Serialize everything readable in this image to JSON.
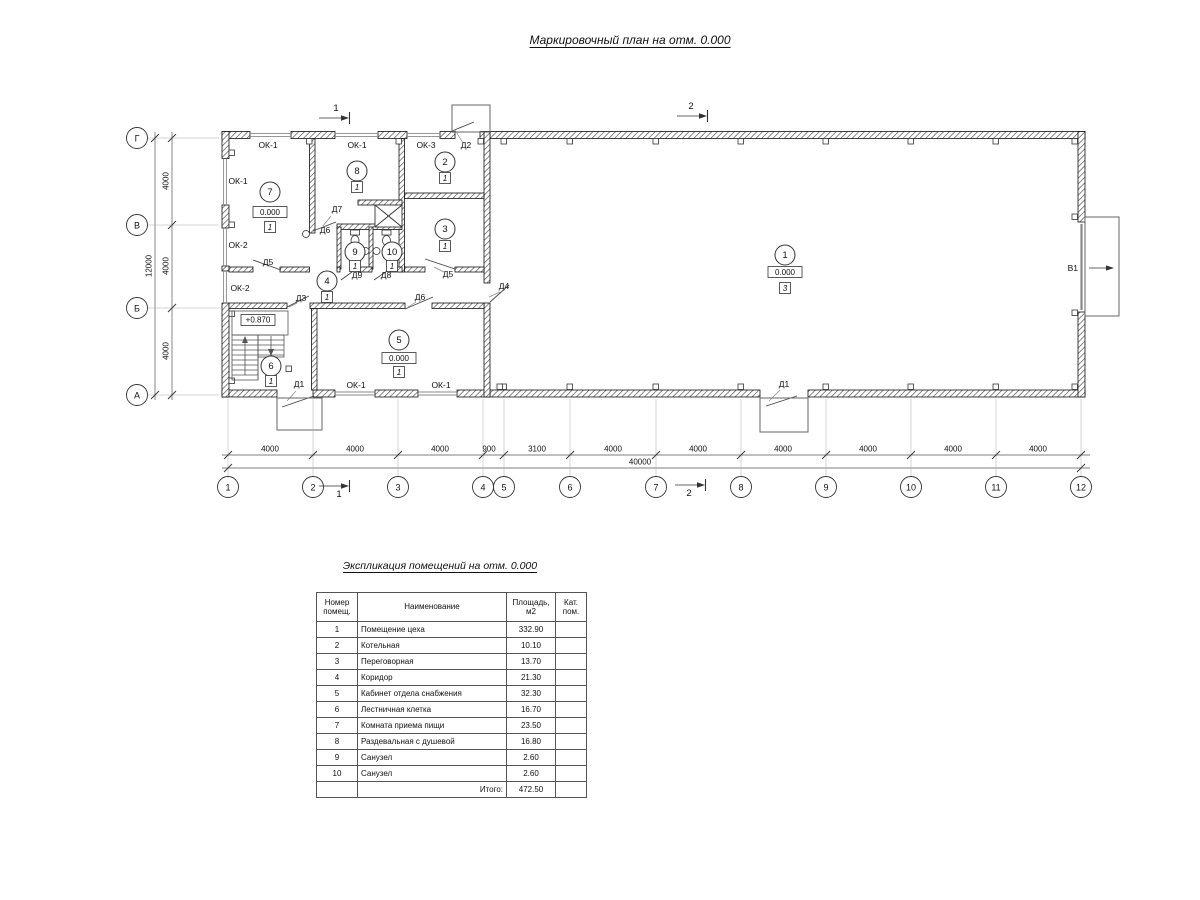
{
  "drawing": {
    "title": "Маркировочный план на отм. 0.000"
  },
  "plan": {
    "axes_cols": [
      [
        "1",
        228
      ],
      [
        "2",
        313
      ],
      [
        "3",
        398
      ],
      [
        "4",
        483
      ],
      [
        "5",
        504
      ],
      [
        "6",
        570
      ],
      [
        "7",
        656
      ],
      [
        "8",
        741
      ],
      [
        "9",
        826
      ],
      [
        "10",
        911
      ],
      [
        "11",
        996
      ],
      [
        "12",
        1081
      ]
    ],
    "axes_rows": [
      [
        "Г",
        138
      ],
      [
        "В",
        225
      ],
      [
        "Б",
        308
      ],
      [
        "А",
        395
      ]
    ],
    "dim_segments_bottom": [
      [
        "4000",
        270
      ],
      [
        "4000",
        355
      ],
      [
        "4000",
        440
      ],
      [
        "900",
        489
      ],
      [
        "3100",
        537
      ],
      [
        "4000",
        613
      ],
      [
        "4000",
        698
      ],
      [
        "4000",
        783
      ],
      [
        "4000",
        868
      ],
      [
        "4000",
        953
      ],
      [
        "4000",
        1038
      ]
    ],
    "dim_total_bottom": [
      "40000",
      640
    ],
    "dim_segments_left": [
      [
        "4000",
        181
      ],
      [
        "4000",
        266
      ],
      [
        "4000",
        351
      ]
    ],
    "dim_total_left": [
      "12000",
      266
    ],
    "marks": [
      [
        "ОК-1",
        268,
        148
      ],
      [
        "ОК-1",
        357,
        148
      ],
      [
        "ОК-3",
        426,
        148
      ],
      [
        "Д2",
        466,
        148
      ],
      [
        "ОК-1",
        238,
        184
      ],
      [
        "ОК-2",
        238,
        248
      ],
      [
        "ОК-2",
        240,
        291
      ],
      [
        "Д5",
        268,
        265
      ],
      [
        "Д6",
        325,
        233
      ],
      [
        "Д7",
        337,
        212
      ],
      [
        "Д5",
        448,
        277
      ],
      [
        "Д4",
        504,
        289
      ],
      [
        "Д9",
        357,
        278
      ],
      [
        "Д8",
        386,
        278
      ],
      [
        "Д3",
        301,
        301
      ],
      [
        "Д6",
        420,
        300
      ],
      [
        "Д1",
        299,
        387
      ],
      [
        "Д1",
        784,
        387
      ],
      [
        "ОК-1",
        356,
        388
      ],
      [
        "ОК-1",
        441,
        388
      ]
    ],
    "rooms": [
      {
        "num": "1",
        "cx": 785,
        "cy": 255,
        "elev": "0.000",
        "elev_y": 272,
        "cat": "3",
        "cat_y": 288
      },
      {
        "num": "2",
        "cx": 445,
        "cy": 162,
        "cat": "1",
        "cat_y": 178
      },
      {
        "num": "3",
        "cx": 445,
        "cy": 229,
        "cat": "1",
        "cat_y": 246
      },
      {
        "num": "4",
        "cx": 327,
        "cy": 281,
        "cat": "1",
        "cat_y": 297
      },
      {
        "num": "5",
        "cx": 399,
        "cy": 340,
        "elev": "0.000",
        "elev_y": 358,
        "cat": "1",
        "cat_y": 372
      },
      {
        "num": "6",
        "cx": 271,
        "cy": 366,
        "cat": "1",
        "cat_y": 381
      },
      {
        "num": "7",
        "cx": 270,
        "cy": 192,
        "elev": "0.000",
        "elev_y": 212,
        "cat": "1",
        "cat_y": 227
      },
      {
        "num": "8",
        "cx": 357,
        "cy": 171,
        "cat": "1",
        "cat_y": 187
      },
      {
        "num": "9",
        "cx": 355,
        "cy": 252,
        "cat": "1",
        "cat_y": 266
      },
      {
        "num": "10",
        "cx": 392,
        "cy": 252,
        "cat": "1",
        "cat_y": 266
      }
    ],
    "stair_elev": "+0.870",
    "section_marks": [
      {
        "num": "1",
        "ax": 327,
        "ay": 118,
        "lx": 336,
        "ly": 111
      },
      {
        "num": "2",
        "ax": 685,
        "ay": 116,
        "lx": 691,
        "ly": 109
      },
      {
        "num": "1",
        "ax": 327,
        "ay": 486,
        "lx": 339,
        "ly": 497
      },
      {
        "num": "2",
        "ax": 683,
        "ay": 485,
        "lx": 689,
        "ly": 496
      }
    ],
    "gate": {
      "label": "В1",
      "x": 1078,
      "y": 271
    }
  },
  "schedule": {
    "title": "Экспликация помещений на отм. 0.000",
    "col_headers": [
      "Номер\nпомещ.",
      "Наименование",
      "Площадь,\nм2",
      "Кат.\nпом."
    ],
    "rows": [
      [
        "1",
        "Помещение цеха",
        "332.90"
      ],
      [
        "2",
        "Котельная",
        "10.10"
      ],
      [
        "3",
        "Переговорная",
        "13.70"
      ],
      [
        "4",
        "Коридор",
        "21.30"
      ],
      [
        "5",
        "Кабинет отдела снабжения",
        "32.30"
      ],
      [
        "6",
        "Лестничная клетка",
        "16.70"
      ],
      [
        "7",
        "Комната приема пищи",
        "23.50"
      ],
      [
        "8",
        "Раздевальная с душевой",
        "16.80"
      ],
      [
        "9",
        "Санузел",
        "2.60"
      ],
      [
        "10",
        "Санузел",
        "2.60"
      ]
    ],
    "total_label": "Итого:",
    "total_value": "472.50"
  }
}
